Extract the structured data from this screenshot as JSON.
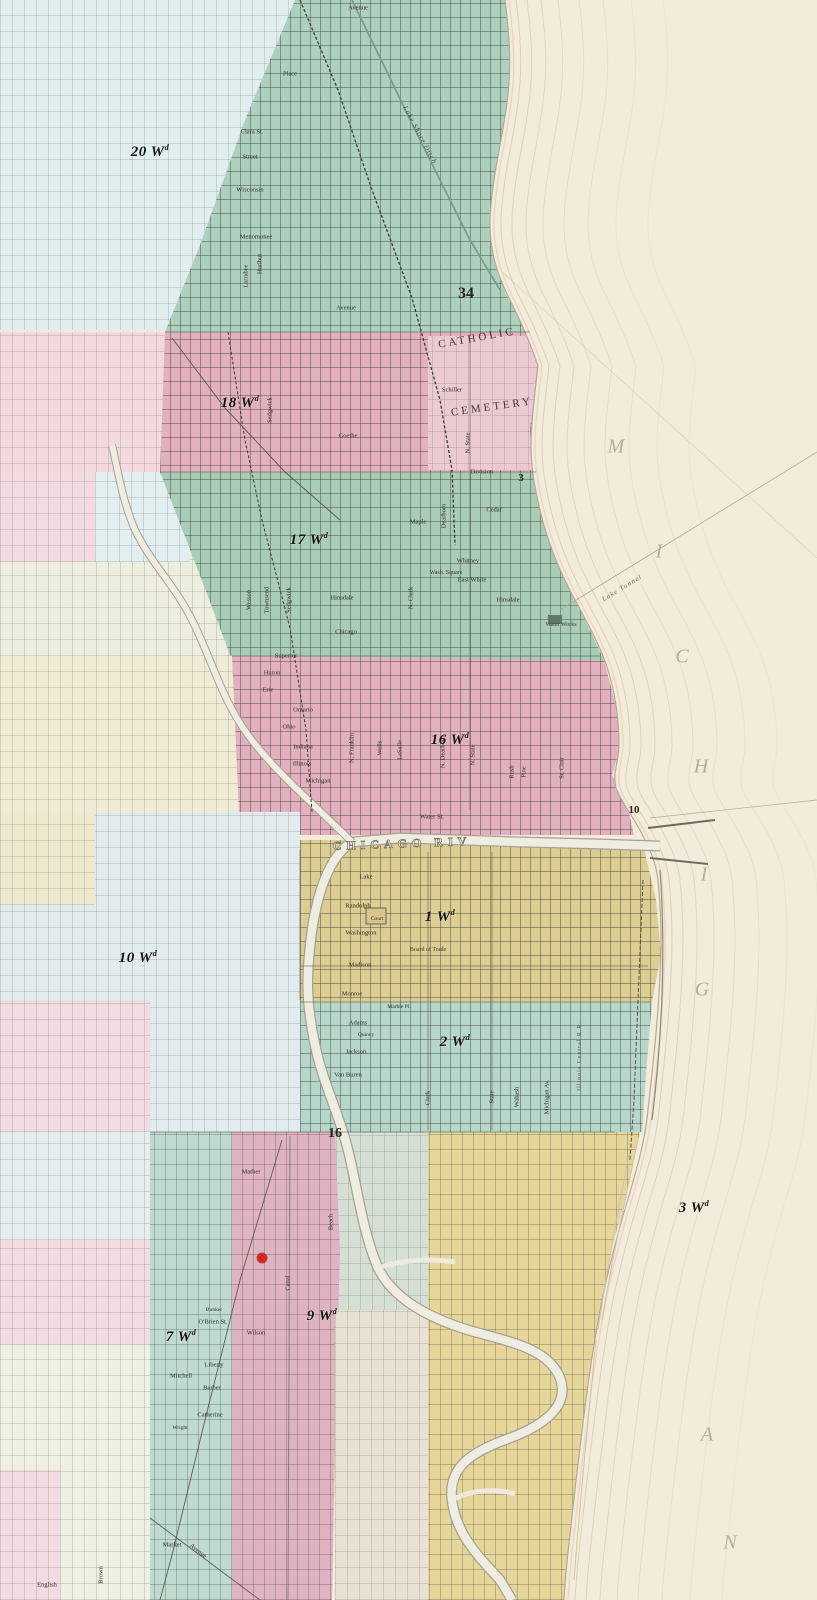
{
  "palette": {
    "lake": "#f3ecda",
    "burnt_green": "#aed0bf",
    "burnt_pink": "#e3b1be",
    "downtown_yellow": "#dcce93",
    "ward2_teal": "#b6d6ca",
    "ward3_yellow": "#e6d69a",
    "pale_blue": "#e1eef0",
    "pale_pink": "#f2dade",
    "river": "#efece2",
    "fire_dot": "#e41f13"
  },
  "wards": [
    {
      "t": "20 Wd",
      "x": 150,
      "y": 152
    },
    {
      "t": "18 Wd",
      "x": 240,
      "y": 403
    },
    {
      "t": "17 Wd",
      "x": 309,
      "y": 540
    },
    {
      "t": "16 Wd",
      "x": 450,
      "y": 740
    },
    {
      "t": "1 Wd",
      "x": 440,
      "y": 917
    },
    {
      "t": "2 Wd",
      "x": 455,
      "y": 1042
    },
    {
      "t": "10 Wd",
      "x": 138,
      "y": 958
    },
    {
      "t": "9 Wd",
      "x": 322,
      "y": 1316
    },
    {
      "t": "7 Wd",
      "x": 181,
      "y": 1337
    },
    {
      "t": "3 Wd",
      "x": 694,
      "y": 1208
    }
  ],
  "sections": [
    {
      "t": "34",
      "x": 466,
      "y": 294,
      "s": 16
    },
    {
      "t": "3",
      "x": 521,
      "y": 478,
      "s": 11
    },
    {
      "t": "10",
      "x": 634,
      "y": 810,
      "s": 11
    },
    {
      "t": "16",
      "x": 335,
      "y": 1134,
      "s": 14
    }
  ],
  "lake_letters": [
    {
      "t": "M",
      "x": 616,
      "y": 447
    },
    {
      "t": "I",
      "x": 659,
      "y": 552
    },
    {
      "t": "C",
      "x": 682,
      "y": 657
    },
    {
      "t": "H",
      "x": 701,
      "y": 767
    },
    {
      "t": "I",
      "x": 704,
      "y": 875
    },
    {
      "t": "G",
      "x": 702,
      "y": 990
    },
    {
      "t": "A",
      "x": 707,
      "y": 1435
    },
    {
      "t": "N",
      "x": 730,
      "y": 1543
    }
  ],
  "features": [
    {
      "t": "CATHOLIC",
      "x": 477,
      "y": 338,
      "r": -10,
      "k": "cem"
    },
    {
      "t": "CEMETERY",
      "x": 492,
      "y": 407,
      "r": -8,
      "k": "cem"
    },
    {
      "t": "CHICAGO RIV",
      "x": 402,
      "y": 844,
      "r": -2,
      "k": "riv"
    },
    {
      "t": "Lake Shore Ditch",
      "x": 420,
      "y": 135,
      "r": 62,
      "k": "ditch"
    },
    {
      "t": "Lake Tunnel",
      "x": 622,
      "y": 588,
      "r": -31,
      "k": "tun"
    },
    {
      "t": "Water Works",
      "x": 561,
      "y": 625,
      "k": "tiny"
    },
    {
      "t": "Wash. Square",
      "x": 446,
      "y": 573,
      "k": "tiny"
    },
    {
      "t": "Board of Trade",
      "x": 428,
      "y": 950,
      "k": "tiny"
    },
    {
      "t": "Illinois Central R.R.",
      "x": 580,
      "y": 1056,
      "r": -90,
      "k": "tiny2"
    }
  ],
  "streets": [
    {
      "t": "Avenue",
      "x": 358,
      "y": 8
    },
    {
      "t": "Place",
      "x": 290,
      "y": 74
    },
    {
      "t": "Clara St.",
      "x": 252,
      "y": 132
    },
    {
      "t": "Street",
      "x": 250,
      "y": 157
    },
    {
      "t": "Wisconsin",
      "x": 250,
      "y": 190
    },
    {
      "t": "Menomonee",
      "x": 256,
      "y": 237
    },
    {
      "t": "Larrabee",
      "x": 246,
      "y": 276,
      "v": 1
    },
    {
      "t": "Hurlbut",
      "x": 260,
      "y": 264,
      "v": 1
    },
    {
      "t": "Avenue",
      "x": 346,
      "y": 308
    },
    {
      "t": "Sedgwick",
      "x": 270,
      "y": 410,
      "v": 1
    },
    {
      "t": "Schiller",
      "x": 452,
      "y": 390
    },
    {
      "t": "Goethe",
      "x": 348,
      "y": 436
    },
    {
      "t": "Division",
      "x": 482,
      "y": 472
    },
    {
      "t": "N. State",
      "x": 468,
      "y": 443,
      "v": 1
    },
    {
      "t": "Cedar",
      "x": 494,
      "y": 510
    },
    {
      "t": "Maple",
      "x": 418,
      "y": 522
    },
    {
      "t": "Whitney",
      "x": 468,
      "y": 561
    },
    {
      "t": "East White",
      "x": 472,
      "y": 580
    },
    {
      "t": "Hinsdale",
      "x": 342,
      "y": 598
    },
    {
      "t": "Hinsdale",
      "x": 508,
      "y": 600
    },
    {
      "t": "Wesson",
      "x": 249,
      "y": 600,
      "v": 1
    },
    {
      "t": "Townsend",
      "x": 267,
      "y": 600,
      "v": 1
    },
    {
      "t": "Sedgwick",
      "x": 289,
      "y": 600,
      "v": 1
    },
    {
      "t": "N. Clark",
      "x": 411,
      "y": 598,
      "v": 1
    },
    {
      "t": "Dearborn",
      "x": 444,
      "y": 516,
      "v": 1
    },
    {
      "t": "Chicago",
      "x": 346,
      "y": 632
    },
    {
      "t": "Superior",
      "x": 286,
      "y": 656
    },
    {
      "t": "Huron",
      "x": 272,
      "y": 673
    },
    {
      "t": "Erie",
      "x": 268,
      "y": 690
    },
    {
      "t": "Ontario",
      "x": 303,
      "y": 710
    },
    {
      "t": "Ohio",
      "x": 289,
      "y": 727
    },
    {
      "t": "Indiana",
      "x": 303,
      "y": 747
    },
    {
      "t": "Illinois",
      "x": 302,
      "y": 764
    },
    {
      "t": "Michigan",
      "x": 318,
      "y": 781
    },
    {
      "t": "N. Franklin",
      "x": 352,
      "y": 748,
      "v": 1
    },
    {
      "t": "Wells",
      "x": 380,
      "y": 748,
      "v": 1
    },
    {
      "t": "LaSalle",
      "x": 400,
      "y": 750,
      "v": 1
    },
    {
      "t": "N. Dearborn",
      "x": 443,
      "y": 752,
      "v": 1
    },
    {
      "t": "N. State",
      "x": 473,
      "y": 755,
      "v": 1
    },
    {
      "t": "Rush",
      "x": 512,
      "y": 772,
      "v": 1
    },
    {
      "t": "Pine",
      "x": 524,
      "y": 772,
      "v": 1
    },
    {
      "t": "St. Clair",
      "x": 562,
      "y": 768,
      "v": 1
    },
    {
      "t": "Water St.",
      "x": 432,
      "y": 817
    },
    {
      "t": "Lake",
      "x": 366,
      "y": 877
    },
    {
      "t": "Randolph",
      "x": 358,
      "y": 906
    },
    {
      "t": "Court",
      "x": 377,
      "y": 919,
      "s": 5.5
    },
    {
      "t": "Washington",
      "x": 361,
      "y": 933
    },
    {
      "t": "Madison",
      "x": 360,
      "y": 965
    },
    {
      "t": "Monroe",
      "x": 352,
      "y": 994
    },
    {
      "t": "Adams",
      "x": 358,
      "y": 1023
    },
    {
      "t": "Quincy",
      "x": 366,
      "y": 1035,
      "s": 5.5
    },
    {
      "t": "Jackson",
      "x": 356,
      "y": 1052
    },
    {
      "t": "Van Buren",
      "x": 348,
      "y": 1075
    },
    {
      "t": "Marble Pl.",
      "x": 399,
      "y": 1007,
      "s": 5.5
    },
    {
      "t": "Clark",
      "x": 428,
      "y": 1098,
      "v": 1
    },
    {
      "t": "State",
      "x": 492,
      "y": 1097,
      "v": 1
    },
    {
      "t": "Wabash",
      "x": 517,
      "y": 1097,
      "v": 1
    },
    {
      "t": "Michigan Av.",
      "x": 547,
      "y": 1097,
      "v": 1
    },
    {
      "t": "Mather",
      "x": 251,
      "y": 1172
    },
    {
      "t": "Bunker",
      "x": 214,
      "y": 1310,
      "s": 5.5
    },
    {
      "t": "O'Brien St.",
      "x": 213,
      "y": 1322
    },
    {
      "t": "Wilson",
      "x": 256,
      "y": 1333
    },
    {
      "t": "Liberty",
      "x": 214,
      "y": 1365
    },
    {
      "t": "Mitchell",
      "x": 181,
      "y": 1376
    },
    {
      "t": "Barber",
      "x": 212,
      "y": 1388
    },
    {
      "t": "Catherine",
      "x": 210,
      "y": 1415
    },
    {
      "t": "Wright",
      "x": 180,
      "y": 1428,
      "s": 5.5
    },
    {
      "t": "Canal",
      "x": 288,
      "y": 1283,
      "v": 1
    },
    {
      "t": "Beach",
      "x": 331,
      "y": 1222,
      "v": 1
    },
    {
      "t": "Brown",
      "x": 101,
      "y": 1575,
      "v": 1
    },
    {
      "t": "English",
      "x": 47,
      "y": 1585
    },
    {
      "t": "Market",
      "x": 172,
      "y": 1545
    },
    {
      "t": "Avenue",
      "x": 198,
      "y": 1551,
      "r": 38
    }
  ],
  "fire_origin": {
    "x": 262,
    "y": 1258,
    "color": "#e41f13"
  }
}
